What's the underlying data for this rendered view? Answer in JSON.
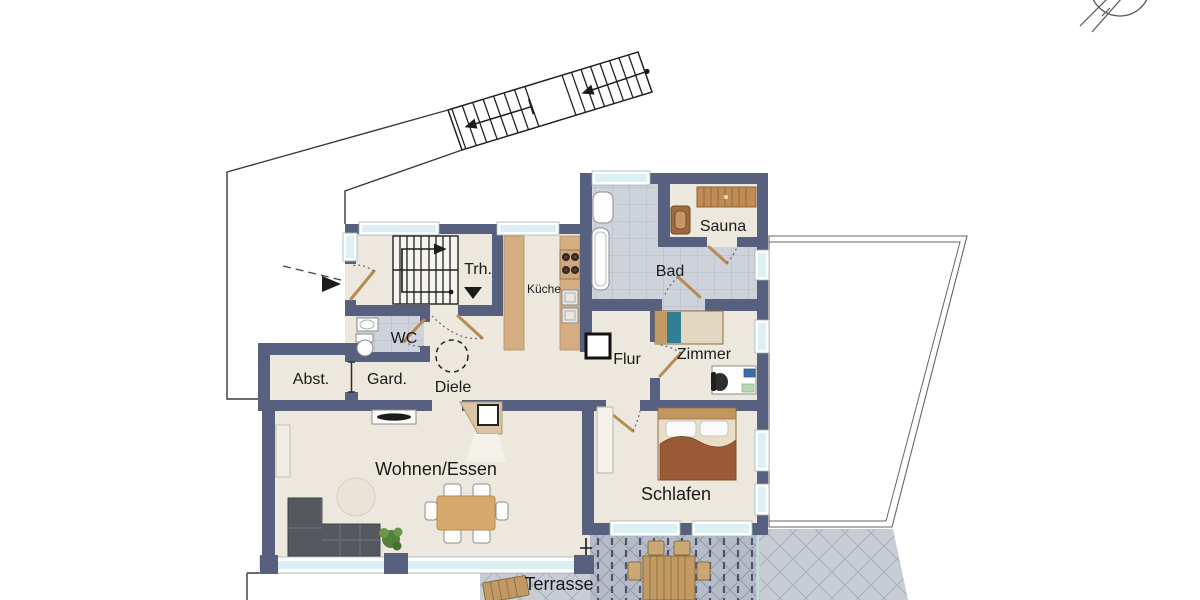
{
  "rooms": {
    "trh": {
      "label": "Trh."
    },
    "kueche": {
      "label": "Küche"
    },
    "bad": {
      "label": "Bad"
    },
    "sauna": {
      "label": "Sauna"
    },
    "wc": {
      "label": "WC"
    },
    "flur": {
      "label": "Flur"
    },
    "zimmer": {
      "label": "Zimmer"
    },
    "abst": {
      "label": "Abst."
    },
    "gard": {
      "label": "Gard."
    },
    "diele": {
      "label": "Diele"
    },
    "wohnen_essen": {
      "label": "Wohnen/Essen"
    },
    "schlafen": {
      "label": "Schlafen"
    },
    "terrasse": {
      "label": "Terrasse"
    }
  },
  "colors": {
    "wall": "#57607e",
    "floor": "#ece8dd",
    "tile": "#ced2da",
    "tileline": "#b4bac6",
    "terrace": "#b6bcc7",
    "terraceline": "#959caa",
    "terrace2": "#c7ccd5",
    "terrace2line": "#a9afbb",
    "window": "#daf0f5",
    "counter": "#d5ad83",
    "wood": "#c0975f",
    "doorwood": "#b98a54",
    "sofa": "#55585f",
    "blanket": "#9a5a35",
    "teal": "#2f7f95",
    "plant": "#55803b",
    "railing": "#4c5470"
  }
}
